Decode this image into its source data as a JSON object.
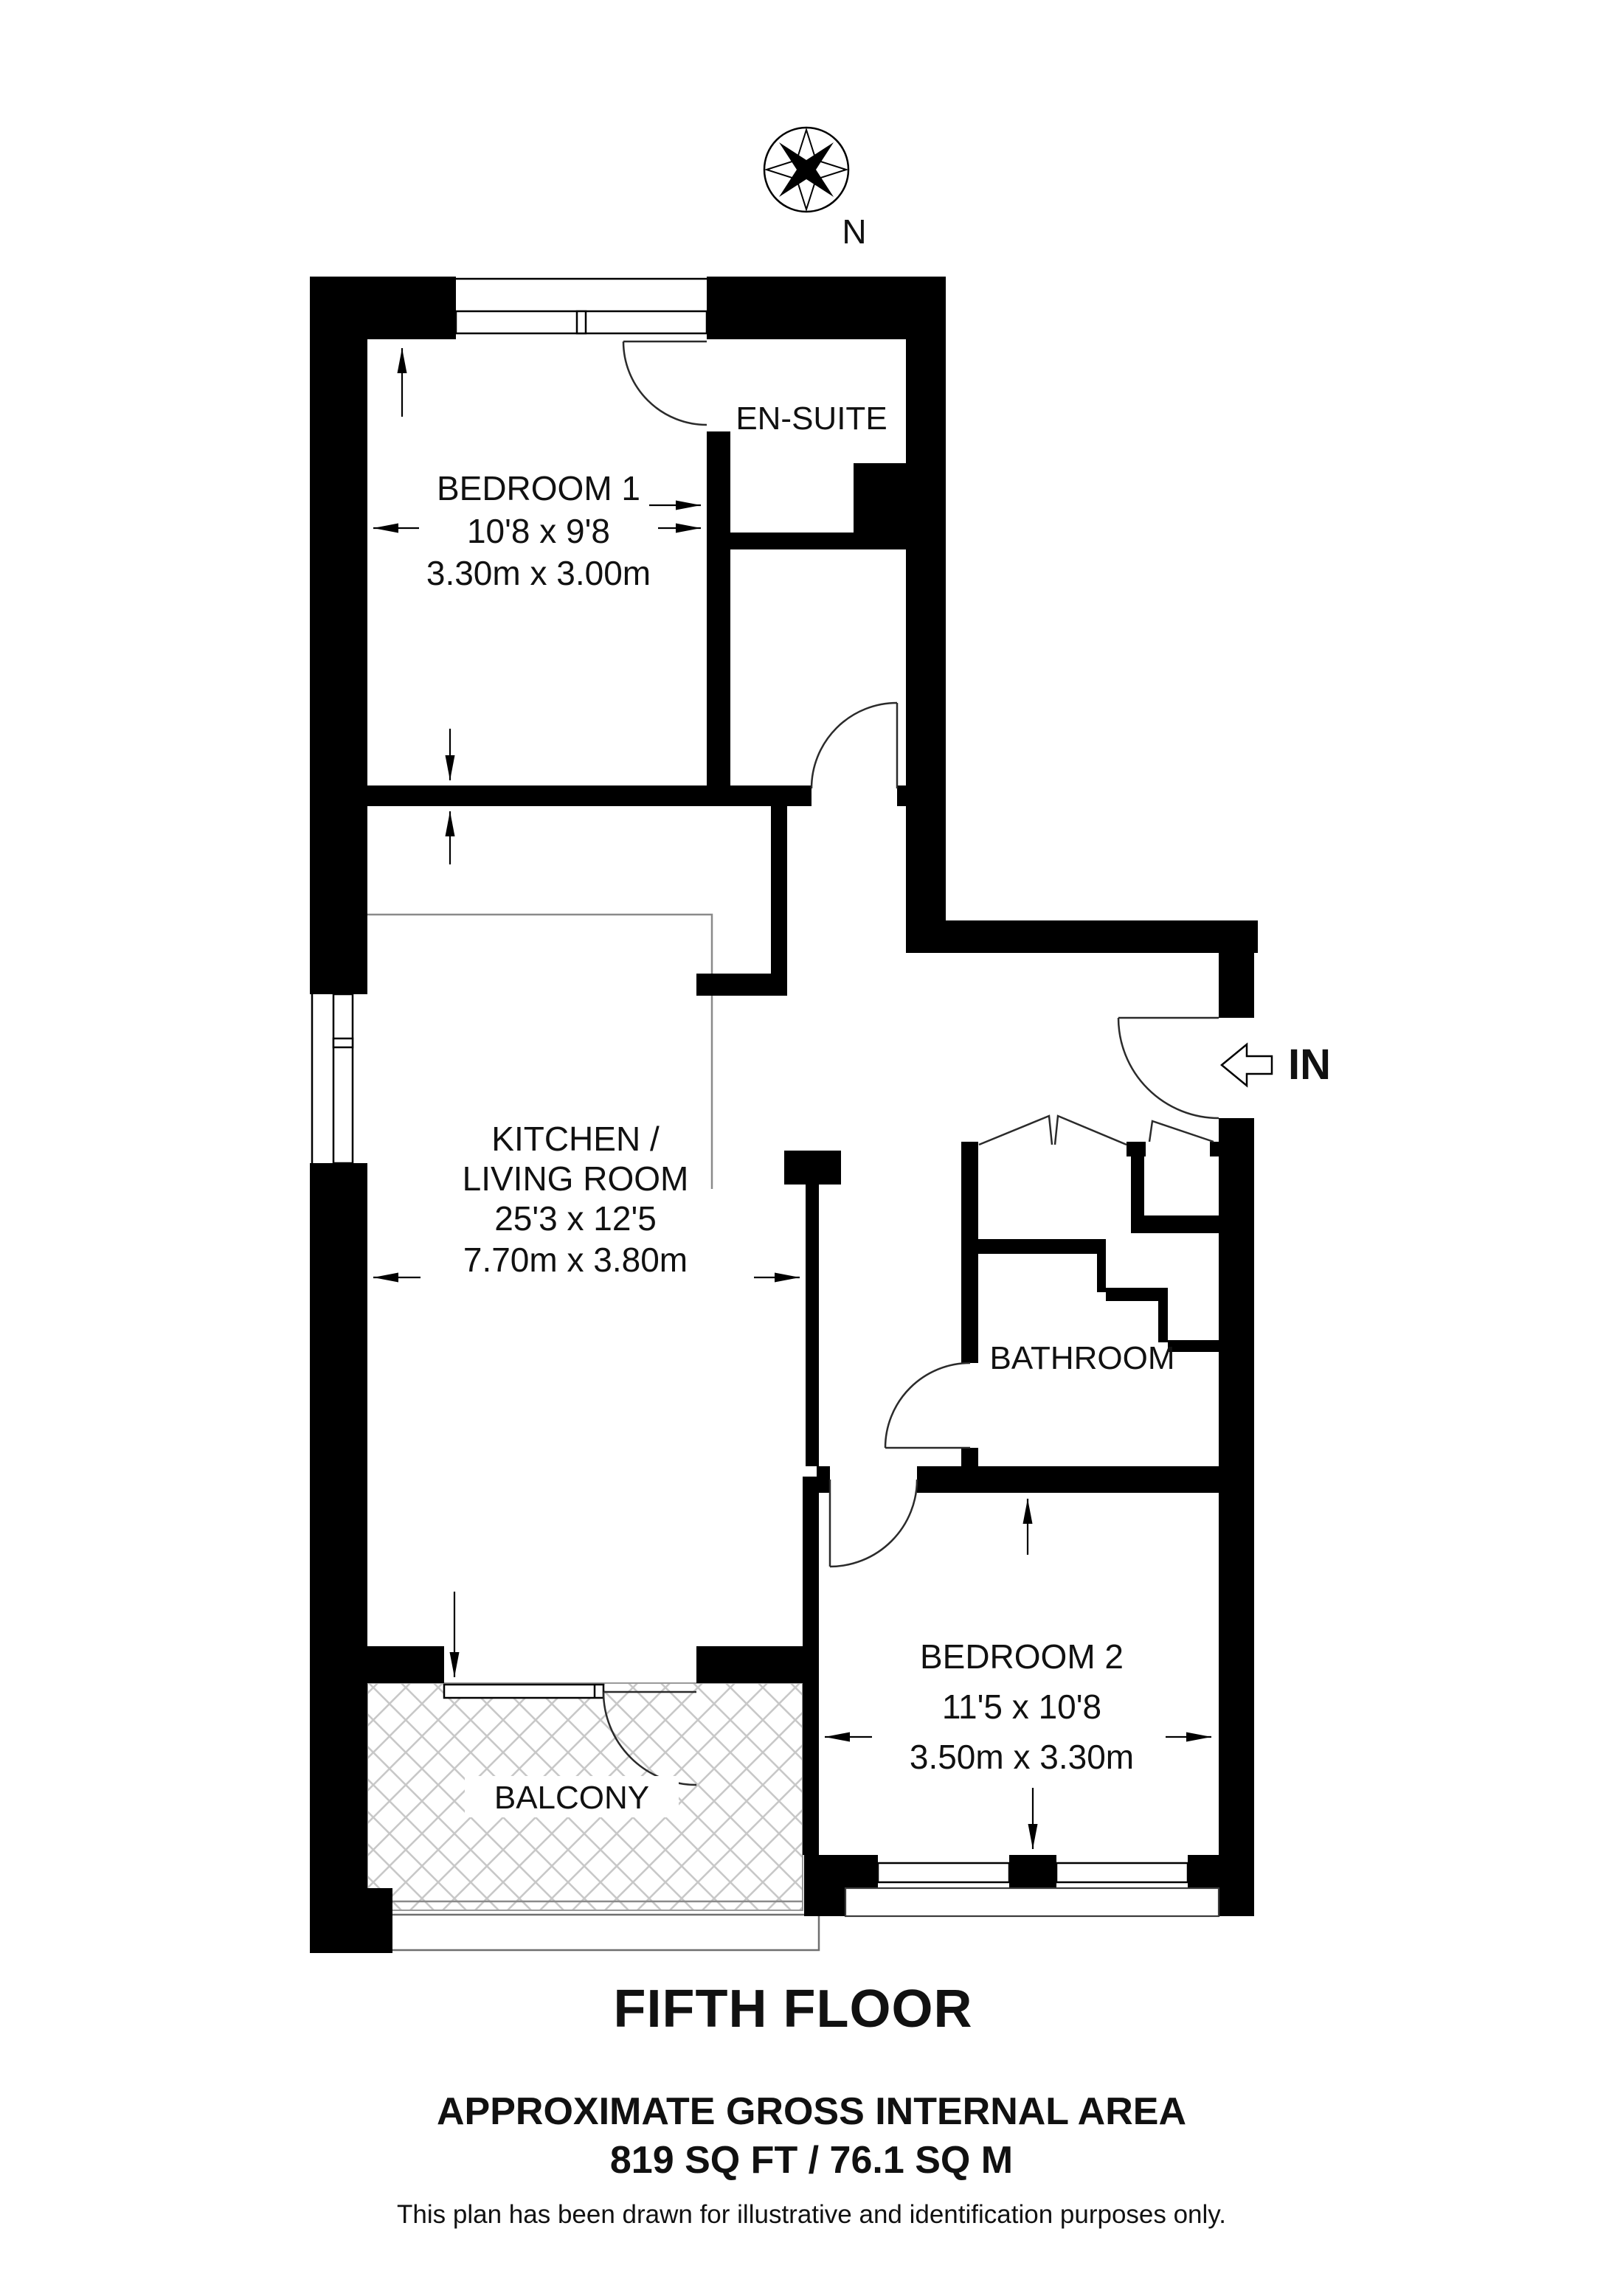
{
  "page": {
    "background": "#ffffff",
    "ink": "#000000",
    "hatch_color": "#c8c8c8"
  },
  "compass": {
    "label": "N"
  },
  "entrance": {
    "label": "IN"
  },
  "rooms": {
    "bedroom1": {
      "name": "BEDROOM 1",
      "dims_ft": "10'8 x 9'8",
      "dims_m": "3.30m x 3.00m"
    },
    "ensuite": {
      "name": "EN-SUITE"
    },
    "kitchen": {
      "name_line1": "KITCHEN /",
      "name_line2": "LIVING ROOM",
      "dims_ft": "25'3 x 12'5",
      "dims_m": "7.70m x 3.80m"
    },
    "bathroom": {
      "name": "BATHROOM"
    },
    "bedroom2": {
      "name": "BEDROOM 2",
      "dims_ft": "11'5 x 10'8",
      "dims_m": "3.50m x 3.30m"
    },
    "balcony": {
      "name": "BALCONY"
    }
  },
  "footer": {
    "floor_title": "FIFTH FLOOR",
    "area_heading": "APPROXIMATE GROSS INTERNAL AREA",
    "area_value": "819 SQ FT / 76.1 SQ M",
    "disclaimer": "This plan has been drawn for illustrative and identification purposes only."
  }
}
